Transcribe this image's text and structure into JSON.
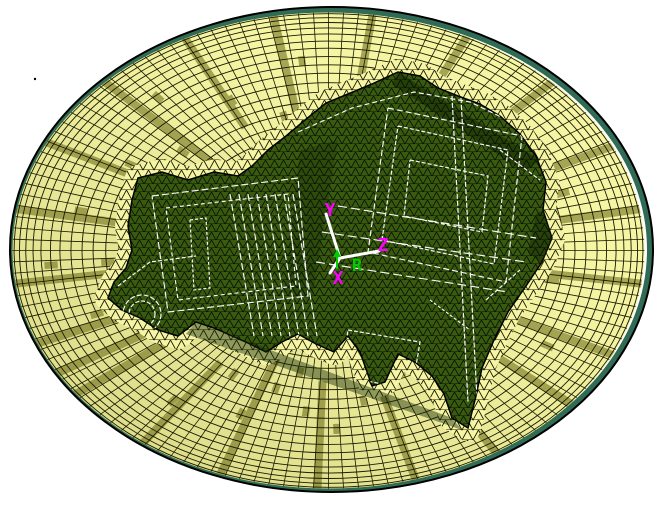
{
  "triad": {
    "y_label": "Y",
    "z_label": "Z",
    "x_label": "X",
    "r_label": "R",
    "axis_label_color": "#FF00FF",
    "r_label_color": "#00CC00",
    "axis_line_color": "#FFFFFF"
  },
  "colors": {
    "background": "#FFFFFF",
    "blank_fill": "#F5F5A4",
    "blank_shade": "rgba(90,90,0,0.20)",
    "stripe_olive": "#A5A554",
    "mesh_line": "#1A1A00",
    "part_fill": "#3A5A10",
    "part_shadow": "#162A04",
    "part_mesh_line": "rgba(0,10,0,0.85)",
    "feature_line": "#FFFFFF",
    "rim_band": "#2F6B55",
    "outline": "#000000"
  }
}
